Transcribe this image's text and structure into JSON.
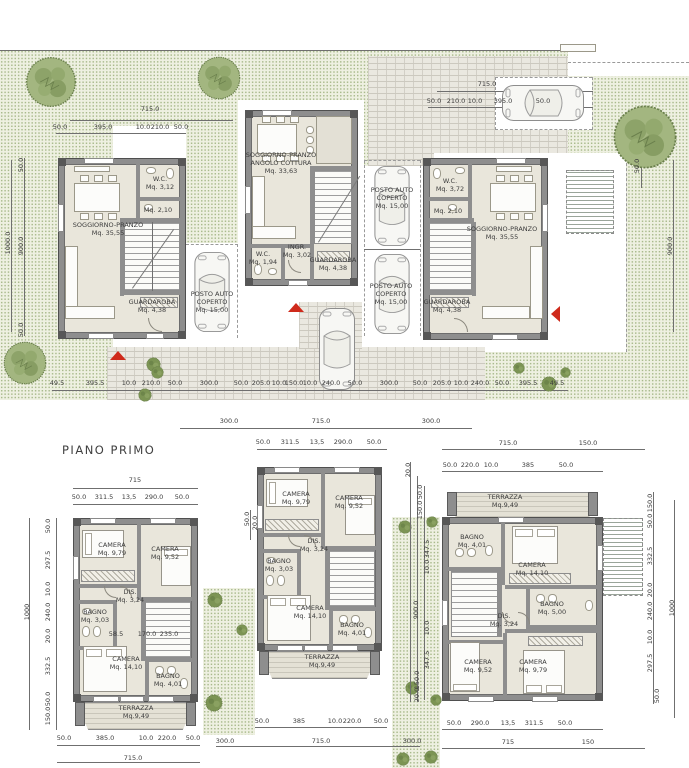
{
  "title": "PIANO PRIMO",
  "colors": {
    "grass": "#eef0e1",
    "grass_dot": "#a9ba8c",
    "wall": "#8e8e8e",
    "floor": "#e9e6db",
    "paving": "#eae8e0",
    "accent_red": "#cf2a1b",
    "dim_text": "#3c3c3c"
  },
  "site_plan": {
    "room_labels": [
      {
        "n": "label-soggiorno-pranzo-left",
        "t": "SOGGIORNO-PRANZO\nMq. 35,55",
        "x": 108,
        "y": 229
      },
      {
        "n": "label-wc-left",
        "t": "W.C.\nMq. 3,12",
        "x": 160,
        "y": 183
      },
      {
        "n": "label-wc2-left",
        "t": "Mq. 2,10",
        "x": 158,
        "y": 210
      },
      {
        "n": "label-guardaroba-left",
        "t": "GUARDAROBA\nMq. 4,38",
        "x": 152,
        "y": 306
      },
      {
        "n": "label-posto-auto-left",
        "t": "POSTO AUTO\nCOPERTO\nMq. 15,00",
        "x": 212,
        "y": 302
      },
      {
        "n": "label-soggiorno-centro",
        "t": "SOGGIORNO-PRANZO\nANGOLO COTTURA\nMq. 33,63",
        "x": 281,
        "y": 163
      },
      {
        "n": "label-ingresso-centro",
        "t": "INGR.\nMq. 3,02",
        "x": 297,
        "y": 251
      },
      {
        "n": "label-wc-centro",
        "t": "W.C.\nMq. 1,94",
        "x": 263,
        "y": 258
      },
      {
        "n": "label-guardaroba-centro",
        "t": "GUARDAROBA\nMq. 4,38",
        "x": 333,
        "y": 264
      },
      {
        "n": "label-posto-auto-centro-1",
        "t": "POSTO AUTO\nCOPERTO\nMq. 15,00",
        "x": 392,
        "y": 198
      },
      {
        "n": "label-posto-auto-centro-2",
        "t": "POSTO AUTO\nCOPERTO\nMq. 15,00",
        "x": 391,
        "y": 294
      },
      {
        "n": "label-wc-right",
        "t": "W.C.\nMq. 3,72",
        "x": 450,
        "y": 185
      },
      {
        "n": "label-wc2-right",
        "t": "Mq. 2,10",
        "x": 448,
        "y": 211
      },
      {
        "n": "label-soggiorno-right",
        "t": "SOGGIORNO-PRANZO\nMq. 35,55",
        "x": 502,
        "y": 233
      },
      {
        "n": "label-guardaroba-right",
        "t": "GUARDAROBA\nMq. 4,38",
        "x": 447,
        "y": 306
      }
    ],
    "dim_labels": [
      {
        "t": "715.0",
        "x": 150,
        "y": 109
      },
      {
        "t": "50.0",
        "x": 60,
        "y": 127
      },
      {
        "t": "395.0",
        "x": 103,
        "y": 127
      },
      {
        "t": "10.0",
        "x": 143,
        "y": 127
      },
      {
        "t": "210.0",
        "x": 160,
        "y": 127
      },
      {
        "t": "50.0",
        "x": 181,
        "y": 127
      },
      {
        "t": "1000.0",
        "x": 8,
        "y": 243,
        "r": 1
      },
      {
        "t": "50.0",
        "x": 21,
        "y": 165,
        "r": 1
      },
      {
        "t": "900.0",
        "x": 21,
        "y": 246,
        "r": 1
      },
      {
        "t": "50.0",
        "x": 21,
        "y": 330,
        "r": 1
      },
      {
        "t": "715.0",
        "x": 487,
        "y": 84
      },
      {
        "t": "50.0",
        "x": 434,
        "y": 101
      },
      {
        "t": "210.0",
        "x": 456,
        "y": 101
      },
      {
        "t": "10.0",
        "x": 475,
        "y": 101
      },
      {
        "t": "395.0",
        "x": 503,
        "y": 101
      },
      {
        "t": "50.0",
        "x": 543,
        "y": 101
      },
      {
        "t": "50.0",
        "x": 637,
        "y": 166,
        "r": 1
      },
      {
        "t": "900.0",
        "x": 670,
        "y": 246,
        "r": 1
      },
      {
        "t": "49.5",
        "x": 57,
        "y": 383
      },
      {
        "t": "395.5",
        "x": 95,
        "y": 383
      },
      {
        "t": "10.0",
        "x": 129,
        "y": 383
      },
      {
        "t": "210.0",
        "x": 151,
        "y": 383
      },
      {
        "t": "50.0",
        "x": 175,
        "y": 383
      },
      {
        "t": "300.0",
        "x": 209,
        "y": 383
      },
      {
        "t": "50.0",
        "x": 241,
        "y": 383
      },
      {
        "t": "205.0",
        "x": 261,
        "y": 383
      },
      {
        "t": "10.0",
        "x": 279,
        "y": 383
      },
      {
        "t": "150.0",
        "x": 294,
        "y": 383
      },
      {
        "t": "10.0",
        "x": 310,
        "y": 383
      },
      {
        "t": "240.0",
        "x": 331,
        "y": 383
      },
      {
        "t": "50.0",
        "x": 355,
        "y": 383
      },
      {
        "t": "300.0",
        "x": 389,
        "y": 383
      },
      {
        "t": "50.0",
        "x": 420,
        "y": 383
      },
      {
        "t": "205.0",
        "x": 442,
        "y": 383
      },
      {
        "t": "10.0",
        "x": 461,
        "y": 383
      },
      {
        "t": "240.0",
        "x": 480,
        "y": 383
      },
      {
        "t": "50.0",
        "x": 502,
        "y": 383
      },
      {
        "t": "395.5",
        "x": 528,
        "y": 383
      },
      {
        "t": "49.5",
        "x": 557,
        "y": 383
      },
      {
        "t": "300.0",
        "x": 229,
        "y": 421
      },
      {
        "t": "715.0",
        "x": 321,
        "y": 421
      },
      {
        "t": "300.0",
        "x": 431,
        "y": 421
      }
    ]
  },
  "first_floor": {
    "room_labels": [
      {
        "n": "label-camera1-left",
        "t": "CAMERA\nMq. 9,79",
        "x": 112,
        "y": 549
      },
      {
        "n": "label-camera2-left",
        "t": "CAMERA\nMq. 9,52",
        "x": 165,
        "y": 553
      },
      {
        "n": "label-dis-left",
        "t": "DIS.\nMq. 3,24",
        "x": 130,
        "y": 596
      },
      {
        "n": "label-bagno1-left",
        "t": "BAGNO\nMq. 3,03",
        "x": 95,
        "y": 616
      },
      {
        "n": "label-camera3-left",
        "t": "CAMERA\nMq. 14,10",
        "x": 126,
        "y": 663
      },
      {
        "n": "label-bagno2-left",
        "t": "BAGNO\nMq. 4,01",
        "x": 168,
        "y": 680
      },
      {
        "n": "label-terrazza-left",
        "t": "TERRAZZA\nMq.9,49",
        "x": 136,
        "y": 712
      },
      {
        "n": "label-camera1-centro",
        "t": "CAMERA\nMq. 9,79",
        "x": 296,
        "y": 498
      },
      {
        "n": "label-camera2-centro",
        "t": "CAMERA\nMq. 9,52",
        "x": 349,
        "y": 502
      },
      {
        "n": "label-dis-centro",
        "t": "DIS.\nMq. 3,24",
        "x": 314,
        "y": 545
      },
      {
        "n": "label-bagno1-centro",
        "t": "BAGNO\nMq. 3,03",
        "x": 279,
        "y": 565
      },
      {
        "n": "label-camera3-centro",
        "t": "CAMERA\nMq. 14,10",
        "x": 310,
        "y": 612
      },
      {
        "n": "label-bagno2-centro",
        "t": "BAGNO\nMq. 4,01",
        "x": 352,
        "y": 629
      },
      {
        "n": "label-terrazza-centro",
        "t": "TERRAZZA\nMq.9,49",
        "x": 322,
        "y": 661
      },
      {
        "n": "label-terrazza-right",
        "t": "TERRAZZA\nMq.9,49",
        "x": 505,
        "y": 501
      },
      {
        "n": "label-bagno1-right",
        "t": "BAGNO\nMq. 4,01",
        "x": 472,
        "y": 541
      },
      {
        "n": "label-camera1-right",
        "t": "CAMERA\nMq. 14,10",
        "x": 532,
        "y": 569
      },
      {
        "n": "label-bagno2-right",
        "t": "BAGNO\nMq. 5,00",
        "x": 552,
        "y": 608
      },
      {
        "n": "label-dis-right",
        "t": "DIS.\nMq. 3,24",
        "x": 504,
        "y": 620
      },
      {
        "n": "label-camera2-right",
        "t": "CAMERA\nMq. 9,52",
        "x": 478,
        "y": 666
      },
      {
        "n": "label-camera3-right",
        "t": "CAMERA\nMq. 9,79",
        "x": 533,
        "y": 666
      }
    ],
    "dim_labels": [
      {
        "t": "715",
        "x": 135,
        "y": 480
      },
      {
        "t": "50.0",
        "x": 79,
        "y": 497
      },
      {
        "t": "311.5",
        "x": 104,
        "y": 497
      },
      {
        "t": "13,5",
        "x": 129,
        "y": 497
      },
      {
        "t": "290.0",
        "x": 154,
        "y": 497
      },
      {
        "t": "50.0",
        "x": 182,
        "y": 497
      },
      {
        "t": "1000",
        "x": 27,
        "y": 612,
        "r": 1
      },
      {
        "t": "50.0",
        "x": 48,
        "y": 526,
        "r": 1
      },
      {
        "t": "297.5",
        "x": 48,
        "y": 560,
        "r": 1
      },
      {
        "t": "10.0",
        "x": 48,
        "y": 589,
        "r": 1
      },
      {
        "t": "240.0",
        "x": 48,
        "y": 612,
        "r": 1
      },
      {
        "t": "20.0",
        "x": 48,
        "y": 636,
        "r": 1
      },
      {
        "t": "332.5",
        "x": 48,
        "y": 666,
        "r": 1
      },
      {
        "t": "50.0",
        "x": 48,
        "y": 699,
        "r": 1
      },
      {
        "t": "150.0",
        "x": 48,
        "y": 716,
        "r": 1
      },
      {
        "t": "58.5",
        "x": 116,
        "y": 634
      },
      {
        "t": "170.0",
        "x": 147,
        "y": 634
      },
      {
        "t": "235.0",
        "x": 169,
        "y": 634
      },
      {
        "t": "50.0",
        "x": 64,
        "y": 738
      },
      {
        "t": "385.0",
        "x": 105,
        "y": 738
      },
      {
        "t": "10.0",
        "x": 146,
        "y": 738
      },
      {
        "t": "220.0",
        "x": 167,
        "y": 738
      },
      {
        "t": "50.0",
        "x": 193,
        "y": 738
      },
      {
        "t": "715.0",
        "x": 133,
        "y": 758
      },
      {
        "t": "50.0",
        "x": 263,
        "y": 442
      },
      {
        "t": "311.5",
        "x": 290,
        "y": 442
      },
      {
        "t": "13,5",
        "x": 317,
        "y": 442
      },
      {
        "t": "290.0",
        "x": 343,
        "y": 442
      },
      {
        "t": "50.0",
        "x": 374,
        "y": 442
      },
      {
        "t": "50.0",
        "x": 247,
        "y": 519,
        "r": 1
      },
      {
        "t": "20.0",
        "x": 255,
        "y": 523,
        "r": 1
      },
      {
        "t": "50.0",
        "x": 262,
        "y": 721
      },
      {
        "t": "385",
        "x": 299,
        "y": 721
      },
      {
        "t": "10.0",
        "x": 335,
        "y": 721
      },
      {
        "t": "220.0",
        "x": 352,
        "y": 721
      },
      {
        "t": "50.0",
        "x": 381,
        "y": 721
      },
      {
        "t": "300.0",
        "x": 225,
        "y": 741
      },
      {
        "t": "715.0",
        "x": 321,
        "y": 741
      },
      {
        "t": "300.0",
        "x": 412,
        "y": 741
      },
      {
        "t": "20.0",
        "x": 408,
        "y": 470,
        "r": 1
      },
      {
        "t": "50.0",
        "x": 420,
        "y": 492,
        "r": 1
      },
      {
        "t": "150.0",
        "x": 420,
        "y": 510,
        "r": 1
      },
      {
        "t": "347.5",
        "x": 427,
        "y": 549,
        "r": 1
      },
      {
        "t": "10.0",
        "x": 427,
        "y": 567,
        "r": 1
      },
      {
        "t": "900.0",
        "x": 416,
        "y": 610,
        "r": 1
      },
      {
        "t": "10.0",
        "x": 427,
        "y": 628,
        "r": 1
      },
      {
        "t": "347.5",
        "x": 427,
        "y": 660,
        "r": 1
      },
      {
        "t": "150.0",
        "x": 417,
        "y": 680,
        "r": 1
      },
      {
        "t": "20.0",
        "x": 417,
        "y": 695,
        "r": 1
      },
      {
        "t": "715.0",
        "x": 508,
        "y": 443
      },
      {
        "t": "150.0",
        "x": 588,
        "y": 443
      },
      {
        "t": "50.0",
        "x": 450,
        "y": 465
      },
      {
        "t": "220.0",
        "x": 470,
        "y": 465
      },
      {
        "t": "10.0",
        "x": 491,
        "y": 465
      },
      {
        "t": "385",
        "x": 528,
        "y": 465
      },
      {
        "t": "50.0",
        "x": 566,
        "y": 465
      },
      {
        "t": "150.0",
        "x": 650,
        "y": 503,
        "r": 1
      },
      {
        "t": "50.0",
        "x": 650,
        "y": 521,
        "r": 1
      },
      {
        "t": "332.5",
        "x": 650,
        "y": 556,
        "r": 1
      },
      {
        "t": "20.0",
        "x": 650,
        "y": 590,
        "r": 1
      },
      {
        "t": "240.0",
        "x": 650,
        "y": 611,
        "r": 1
      },
      {
        "t": "10.0",
        "x": 650,
        "y": 637,
        "r": 1
      },
      {
        "t": "297.5",
        "x": 650,
        "y": 663,
        "r": 1
      },
      {
        "t": "50.0",
        "x": 657,
        "y": 696,
        "r": 1
      },
      {
        "t": "1000",
        "x": 672,
        "y": 608,
        "r": 1
      },
      {
        "t": "50.0",
        "x": 454,
        "y": 723
      },
      {
        "t": "290.0",
        "x": 480,
        "y": 723
      },
      {
        "t": "13,5",
        "x": 508,
        "y": 723
      },
      {
        "t": "311.5",
        "x": 534,
        "y": 723
      },
      {
        "t": "50.0",
        "x": 565,
        "y": 723
      },
      {
        "t": "715",
        "x": 508,
        "y": 742
      },
      {
        "t": "150",
        "x": 588,
        "y": 742
      }
    ]
  }
}
